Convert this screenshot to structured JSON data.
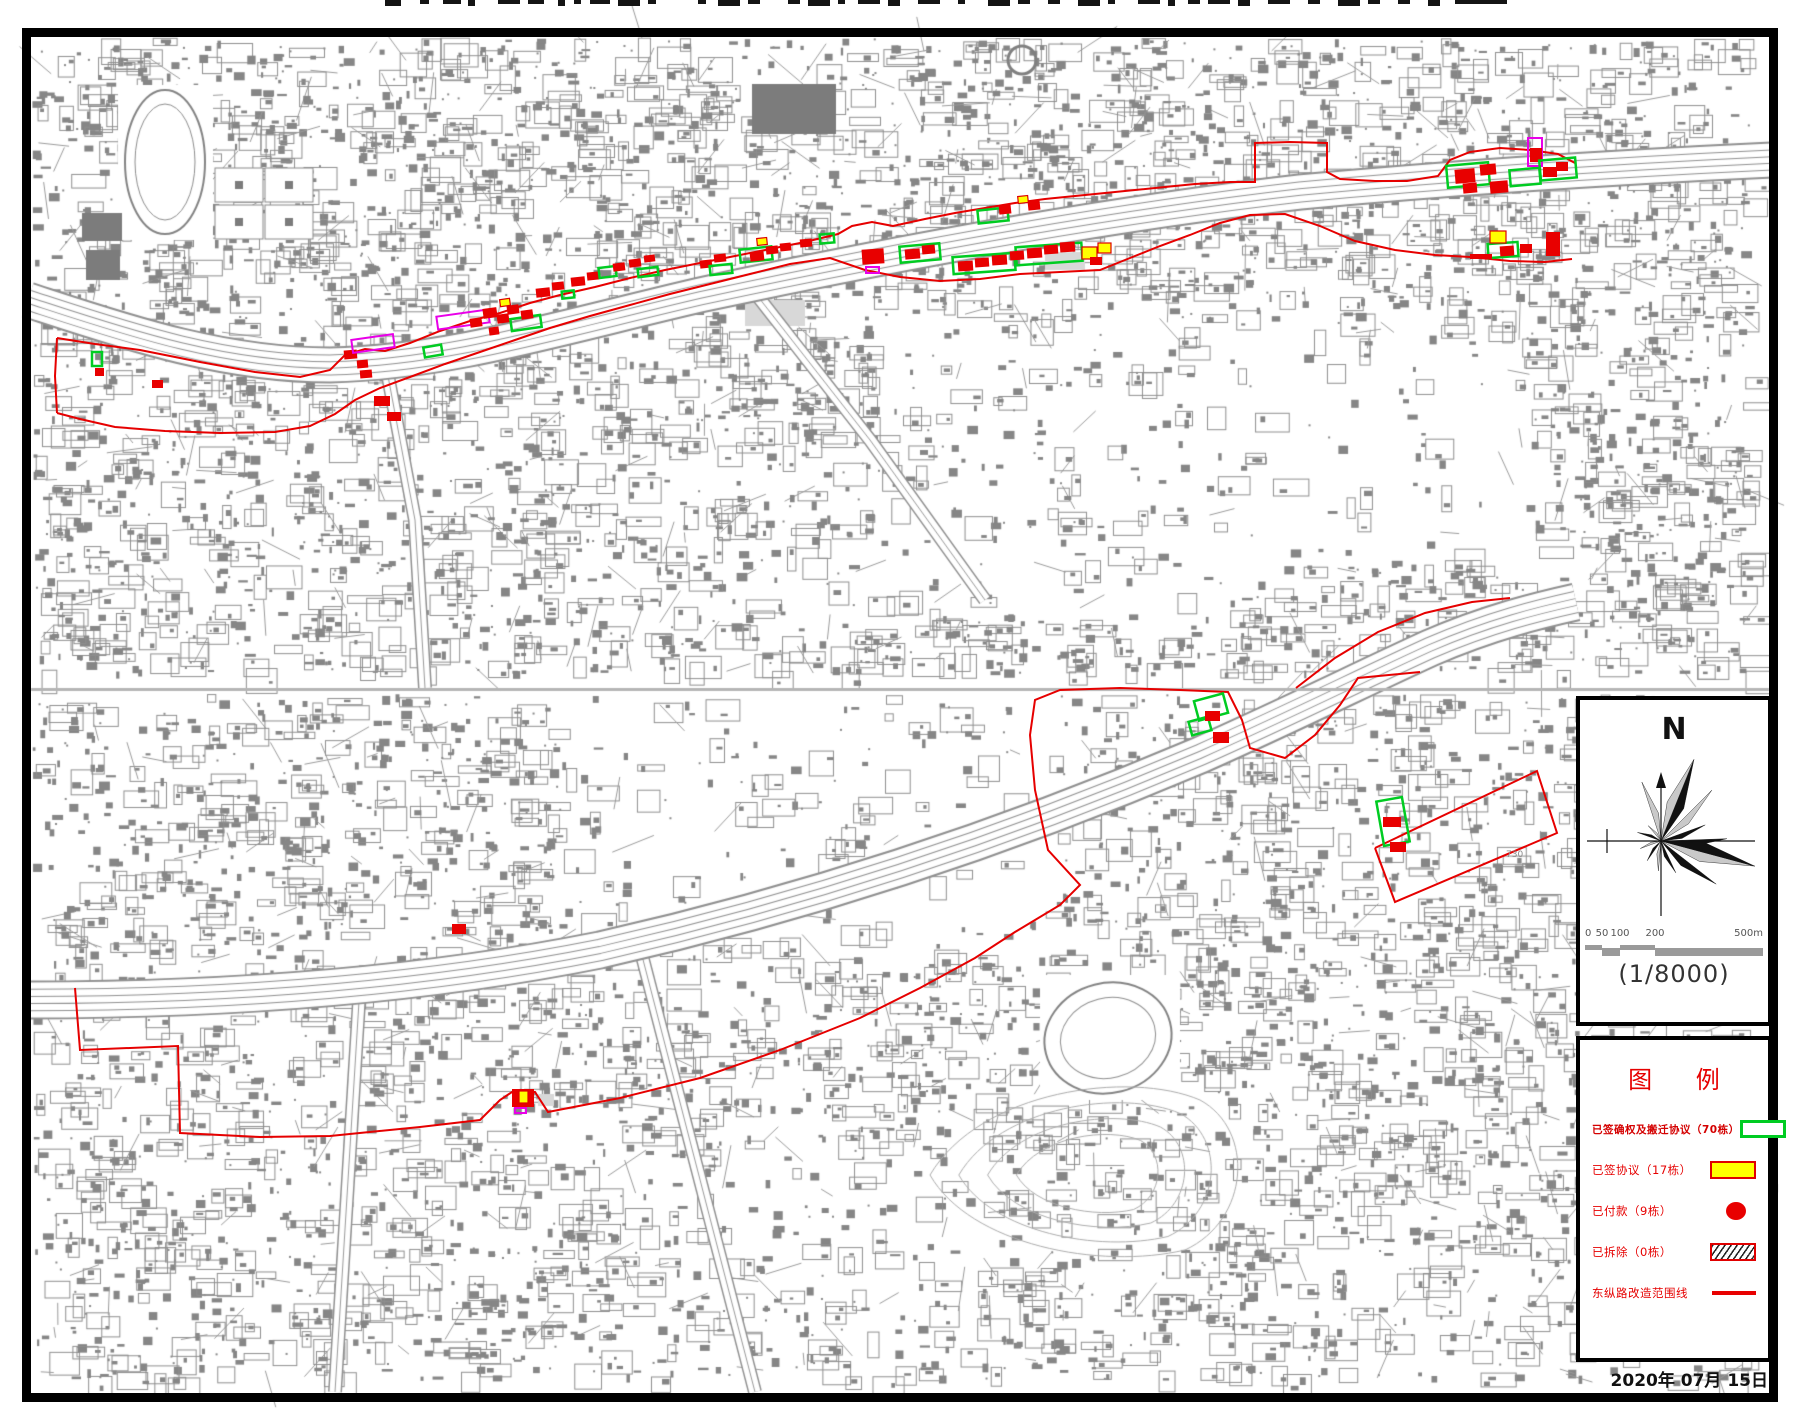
{
  "page": {
    "date": "2020年 07月 15日"
  },
  "compass": {
    "north_label": "N",
    "scale_ratio": "(1/8000)",
    "scale_ticks": [
      "0",
      "50",
      "100",
      "200",
      "500m"
    ]
  },
  "legend": {
    "title": "图 例",
    "items": [
      {
        "label": "已签确权及搬迁协议（70栋）",
        "count": 70,
        "symbol": "green-outline-rect",
        "emphasis": true
      },
      {
        "label": "已签协议（17栋）",
        "count": 17,
        "symbol": "yellow-rect",
        "emphasis": false
      },
      {
        "label": "已付款（9栋）",
        "count": 9,
        "symbol": "red-circle",
        "emphasis": false
      },
      {
        "label": "已拆除（0栋）",
        "count": 0,
        "symbol": "hatched-rect",
        "emphasis": false
      },
      {
        "label": "东纵路改造范围线",
        "symbol": "red-line",
        "emphasis": false
      }
    ]
  },
  "colors": {
    "scope_red": "#e60000",
    "marker_red": "#e80000",
    "marker_green": "#00cc22",
    "marker_yellow": "#ffff00",
    "marker_magenta": "#e800e8",
    "legend_text": "#e60000",
    "map_gray": "#868686"
  },
  "map": {
    "labels": [
      {
        "text": "730",
        "x": 1506,
        "y": 850
      }
    ],
    "scope_lines": {
      "top_north": [
        [
          57,
          338
        ],
        [
          95,
          344
        ],
        [
          140,
          350
        ],
        [
          200,
          362
        ],
        [
          255,
          372
        ],
        [
          300,
          377
        ],
        [
          330,
          370
        ],
        [
          345,
          355
        ],
        [
          365,
          349
        ],
        [
          385,
          351
        ],
        [
          410,
          343
        ],
        [
          440,
          331
        ],
        [
          470,
          321
        ],
        [
          500,
          313
        ],
        [
          530,
          303
        ],
        [
          560,
          295
        ],
        [
          595,
          287
        ],
        [
          630,
          278
        ],
        [
          665,
          270
        ],
        [
          700,
          263
        ],
        [
          735,
          256
        ],
        [
          770,
          249
        ],
        [
          805,
          242
        ],
        [
          838,
          234
        ],
        [
          852,
          226
        ],
        [
          872,
          222
        ],
        [
          893,
          226
        ],
        [
          925,
          219
        ],
        [
          955,
          213
        ],
        [
          985,
          208
        ],
        [
          1015,
          203
        ],
        [
          1045,
          199
        ],
        [
          1075,
          196
        ],
        [
          1105,
          193
        ],
        [
          1135,
          190
        ],
        [
          1165,
          187
        ],
        [
          1195,
          184
        ],
        [
          1230,
          182
        ],
        [
          1255,
          182
        ],
        [
          1255,
          143
        ],
        [
          1290,
          142
        ],
        [
          1327,
          143
        ],
        [
          1327,
          172
        ],
        [
          1340,
          179
        ],
        [
          1375,
          181
        ],
        [
          1407,
          181
        ],
        [
          1438,
          176
        ],
        [
          1450,
          160
        ],
        [
          1470,
          152
        ],
        [
          1500,
          148
        ],
        [
          1530,
          150
        ],
        [
          1558,
          154
        ],
        [
          1575,
          163
        ]
      ],
      "top_south": [
        [
          57,
          413
        ],
        [
          80,
          419
        ],
        [
          115,
          427
        ],
        [
          165,
          431
        ],
        [
          220,
          433
        ],
        [
          275,
          432
        ],
        [
          310,
          426
        ],
        [
          335,
          414
        ],
        [
          355,
          400
        ],
        [
          380,
          388
        ],
        [
          410,
          377
        ],
        [
          445,
          364
        ],
        [
          480,
          352
        ],
        [
          515,
          340
        ],
        [
          550,
          328
        ],
        [
          590,
          316
        ],
        [
          630,
          305
        ],
        [
          670,
          294
        ],
        [
          710,
          284
        ],
        [
          750,
          274
        ],
        [
          790,
          264
        ],
        [
          830,
          258
        ],
        [
          865,
          270
        ],
        [
          900,
          277
        ],
        [
          940,
          281
        ],
        [
          980,
          279
        ],
        [
          1020,
          274
        ],
        [
          1060,
          272
        ],
        [
          1100,
          270
        ],
        [
          1130,
          258
        ],
        [
          1160,
          246
        ],
        [
          1190,
          235
        ],
        [
          1220,
          223
        ],
        [
          1250,
          215
        ],
        [
          1285,
          214
        ],
        [
          1320,
          226
        ],
        [
          1355,
          241
        ],
        [
          1395,
          250
        ],
        [
          1435,
          255
        ],
        [
          1470,
          257
        ],
        [
          1510,
          261
        ],
        [
          1545,
          262
        ],
        [
          1572,
          259
        ]
      ],
      "top_left_edge": [
        [
          57,
          338
        ],
        [
          55,
          376
        ],
        [
          57,
          413
        ]
      ],
      "top_right_tail": [
        [
          1296,
          688
        ],
        [
          1335,
          658
        ],
        [
          1378,
          632
        ],
        [
          1425,
          613
        ],
        [
          1472,
          602
        ],
        [
          1510,
          598
        ]
      ],
      "bottom_main": [
        [
          75,
          988
        ],
        [
          80,
          1050
        ],
        [
          178,
          1046
        ],
        [
          180,
          1133
        ],
        [
          260,
          1137
        ],
        [
          330,
          1136
        ],
        [
          420,
          1127
        ],
        [
          480,
          1120
        ],
        [
          500,
          1100
        ],
        [
          512,
          1092
        ],
        [
          535,
          1092
        ],
        [
          548,
          1112
        ],
        [
          620,
          1098
        ],
        [
          700,
          1078
        ],
        [
          780,
          1050
        ],
        [
          860,
          1018
        ],
        [
          920,
          988
        ],
        [
          975,
          958
        ],
        [
          1015,
          932
        ],
        [
          1060,
          905
        ],
        [
          1080,
          885
        ],
        [
          1048,
          850
        ],
        [
          1035,
          790
        ],
        [
          1030,
          735
        ],
        [
          1035,
          700
        ],
        [
          1060,
          690
        ],
        [
          1120,
          688
        ],
        [
          1180,
          690
        ],
        [
          1228,
          692
        ],
        [
          1242,
          720
        ],
        [
          1250,
          748
        ],
        [
          1285,
          758
        ],
        [
          1315,
          735
        ],
        [
          1340,
          705
        ],
        [
          1358,
          678
        ],
        [
          1420,
          672
        ]
      ],
      "bottom_quad": [
        [
          1375,
          848
        ],
        [
          1537,
          771
        ],
        [
          1557,
          833
        ],
        [
          1395,
          902
        ],
        [
          1375,
          848
        ]
      ]
    },
    "markers": {
      "top": [
        [
          92,
          352,
          10,
          14,
          "green",
          0
        ],
        [
          95,
          368,
          9,
          8,
          "red",
          0
        ],
        [
          152,
          380,
          11,
          8,
          "red",
          0
        ],
        [
          344,
          350,
          13,
          9,
          "red",
          -5
        ],
        [
          357,
          360,
          11,
          8,
          "red",
          -5
        ],
        [
          352,
          337,
          42,
          13,
          "magenta",
          -8
        ],
        [
          360,
          370,
          12,
          8,
          "red",
          -5
        ],
        [
          374,
          396,
          16,
          10,
          "red",
          0
        ],
        [
          387,
          412,
          14,
          9,
          "red",
          0
        ],
        [
          424,
          346,
          18,
          10,
          "green",
          -10
        ],
        [
          437,
          313,
          52,
          13,
          "magenta",
          -8
        ],
        [
          470,
          318,
          12,
          9,
          "red",
          -8
        ],
        [
          483,
          308,
          14,
          10,
          "red",
          -8
        ],
        [
          497,
          314,
          12,
          9,
          "red",
          -8
        ],
        [
          489,
          327,
          10,
          8,
          "red",
          -8
        ],
        [
          507,
          305,
          12,
          9,
          "red",
          -8
        ],
        [
          511,
          317,
          30,
          12,
          "green",
          -8
        ],
        [
          500,
          299,
          10,
          7,
          "yellow",
          -8
        ],
        [
          521,
          310,
          12,
          9,
          "red",
          -8
        ],
        [
          536,
          288,
          14,
          9,
          "red",
          -6
        ],
        [
          552,
          282,
          12,
          8,
          "red",
          -6
        ],
        [
          562,
          291,
          12,
          7,
          "green",
          -6
        ],
        [
          571,
          277,
          14,
          9,
          "red",
          -6
        ],
        [
          587,
          272,
          12,
          8,
          "red",
          -6
        ],
        [
          599,
          267,
          17,
          10,
          "green",
          -7
        ],
        [
          613,
          263,
          12,
          8,
          "red",
          -7
        ],
        [
          629,
          259,
          12,
          8,
          "red",
          -7
        ],
        [
          644,
          255,
          11,
          7,
          "red",
          -7
        ],
        [
          638,
          268,
          20,
          8,
          "green",
          -7
        ],
        [
          700,
          260,
          12,
          8,
          "red",
          -6
        ],
        [
          714,
          254,
          12,
          8,
          "red",
          -6
        ],
        [
          710,
          265,
          22,
          9,
          "green",
          -6
        ],
        [
          740,
          248,
          32,
          13,
          "green",
          -6
        ],
        [
          750,
          252,
          14,
          9,
          "red",
          -6
        ],
        [
          766,
          246,
          12,
          8,
          "red",
          -6
        ],
        [
          757,
          238,
          10,
          7,
          "yellow",
          -6
        ],
        [
          780,
          243,
          11,
          8,
          "red",
          -6
        ],
        [
          800,
          239,
          12,
          8,
          "red",
          -5
        ],
        [
          820,
          234,
          14,
          9,
          "green",
          -5
        ],
        [
          862,
          249,
          22,
          15,
          "red",
          -4
        ],
        [
          866,
          267,
          13,
          6,
          "magenta",
          0
        ],
        [
          900,
          245,
          40,
          16,
          "green",
          -5
        ],
        [
          905,
          249,
          15,
          10,
          "red",
          -5
        ],
        [
          922,
          245,
          13,
          9,
          "red",
          -5
        ],
        [
          953,
          255,
          62,
          17,
          "green",
          -4
        ],
        [
          958,
          261,
          15,
          10,
          "red",
          -4
        ],
        [
          975,
          258,
          14,
          9,
          "red",
          -4
        ],
        [
          992,
          255,
          15,
          10,
          "red",
          -4
        ],
        [
          1016,
          245,
          66,
          18,
          "green",
          -4
        ],
        [
          1010,
          251,
          14,
          9,
          "red",
          -4
        ],
        [
          1027,
          248,
          15,
          10,
          "red",
          -4
        ],
        [
          1044,
          245,
          14,
          9,
          "red",
          -4
        ],
        [
          1060,
          242,
          15,
          10,
          "red",
          -4
        ],
        [
          1082,
          247,
          15,
          12,
          "yellow",
          0
        ],
        [
          1098,
          243,
          13,
          10,
          "yellow",
          0
        ],
        [
          1090,
          257,
          12,
          8,
          "red",
          0
        ],
        [
          978,
          209,
          30,
          13,
          "green",
          -6
        ],
        [
          999,
          205,
          12,
          9,
          "red",
          -6
        ],
        [
          1028,
          201,
          12,
          9,
          "red",
          -6
        ],
        [
          1018,
          196,
          10,
          7,
          "yellow",
          -6
        ],
        [
          1447,
          164,
          42,
          22,
          "green",
          -5
        ],
        [
          1455,
          169,
          20,
          14,
          "red",
          -5
        ],
        [
          1480,
          164,
          16,
          11,
          "red",
          -5
        ],
        [
          1463,
          183,
          14,
          10,
          "red",
          -5
        ],
        [
          1490,
          181,
          18,
          12,
          "red",
          -5
        ],
        [
          1510,
          169,
          30,
          16,
          "green",
          -5
        ],
        [
          1528,
          138,
          14,
          28,
          "magenta",
          0
        ],
        [
          1530,
          148,
          12,
          14,
          "red",
          0
        ],
        [
          1540,
          159,
          36,
          20,
          "green",
          -5
        ],
        [
          1543,
          167,
          14,
          10,
          "red",
          0
        ],
        [
          1556,
          162,
          12,
          9,
          "red",
          0
        ],
        [
          1488,
          243,
          30,
          14,
          "green",
          -4
        ],
        [
          1500,
          246,
          14,
          10,
          "red",
          -4
        ],
        [
          1490,
          231,
          16,
          12,
          "yellow",
          0
        ],
        [
          1546,
          232,
          14,
          24,
          "red",
          0
        ],
        [
          1520,
          244,
          12,
          9,
          "red",
          0
        ],
        [
          1470,
          254,
          22,
          5,
          "red",
          0
        ]
      ],
      "bottom": [
        [
          1196,
          697,
          30,
          20,
          "green",
          -15
        ],
        [
          1190,
          719,
          20,
          14,
          "green",
          -15
        ],
        [
          1205,
          711,
          15,
          10,
          "red",
          0
        ],
        [
          1213,
          732,
          16,
          11,
          "red",
          0
        ],
        [
          1380,
          799,
          26,
          45,
          "green",
          -10
        ],
        [
          1383,
          817,
          18,
          10,
          "red",
          0
        ],
        [
          1390,
          842,
          16,
          10,
          "red",
          0
        ],
        [
          512,
          1089,
          22,
          18,
          "red",
          0
        ],
        [
          519,
          1091,
          9,
          12,
          "yellow",
          0
        ],
        [
          515,
          1108,
          11,
          5,
          "magenta",
          0
        ],
        [
          452,
          924,
          14,
          10,
          "red",
          0
        ]
      ]
    }
  },
  "title_fragments": [
    [
      385,
      16
    ],
    [
      420,
      9
    ],
    [
      443,
      18
    ],
    [
      468,
      7
    ],
    [
      498,
      22
    ],
    [
      528,
      16
    ],
    [
      558,
      7
    ],
    [
      574,
      7
    ],
    [
      590,
      20
    ],
    [
      618,
      22
    ],
    [
      648,
      8
    ],
    [
      698,
      8
    ],
    [
      718,
      22
    ],
    [
      748,
      12
    ],
    [
      788,
      12
    ],
    [
      808,
      22
    ],
    [
      838,
      7
    ],
    [
      858,
      22
    ],
    [
      888,
      12
    ],
    [
      918,
      22
    ],
    [
      958,
      7
    ],
    [
      988,
      22
    ],
    [
      1018,
      12
    ],
    [
      1048,
      12
    ],
    [
      1078,
      22
    ],
    [
      1108,
      7
    ],
    [
      1138,
      22
    ],
    [
      1168,
      7
    ],
    [
      1188,
      12
    ],
    [
      1208,
      22
    ],
    [
      1238,
      12
    ],
    [
      1268,
      22
    ],
    [
      1308,
      12
    ],
    [
      1338,
      22
    ],
    [
      1368,
      12
    ],
    [
      1398,
      12
    ],
    [
      1428,
      12
    ],
    [
      1455,
      52
    ]
  ]
}
